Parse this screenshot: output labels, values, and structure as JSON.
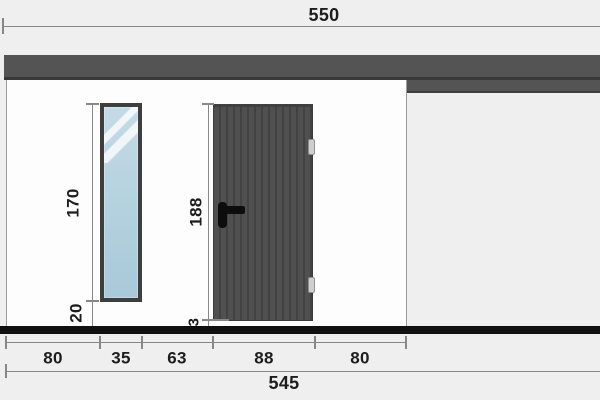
{
  "drawing": {
    "type": "architectural-elevation",
    "elements": [
      "roof-band",
      "wall-panel",
      "tall-window",
      "plank-door",
      "door-handle",
      "door-hinges",
      "ground-line"
    ]
  },
  "dimensions": {
    "top_total": "550",
    "bottom": {
      "segments": [
        "80",
        "35",
        "63",
        "88",
        "80"
      ],
      "total": "545"
    },
    "window": {
      "height": "170",
      "sill_height": "20"
    },
    "door": {
      "height": "188",
      "bottom_gap": "3"
    }
  },
  "colors": {
    "background": "#f0efef",
    "wall": "#fdfdfd",
    "roof": "#545454",
    "door": "#4a4a4a",
    "glass": "#b3d1de",
    "floor": "#101010",
    "dim": "#878787",
    "text": "#1d1d1d"
  }
}
